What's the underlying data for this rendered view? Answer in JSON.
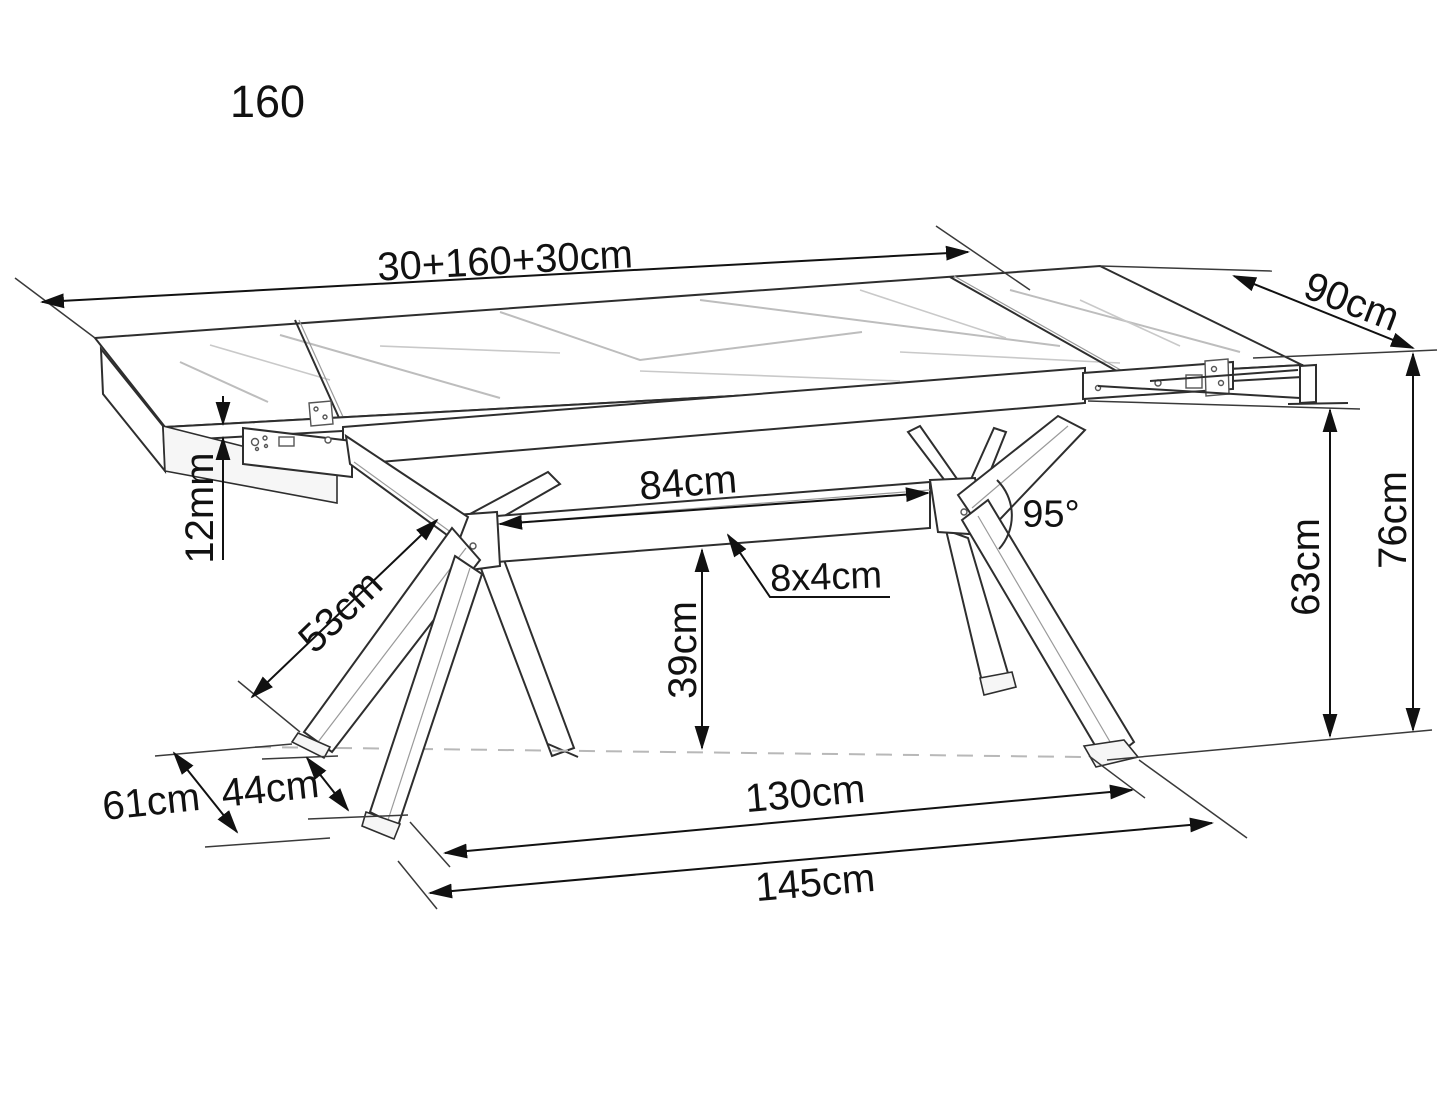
{
  "diagram": {
    "type": "furniture-dimension-drawing",
    "subject": "extendable dining table with spider metal legs and two extension leaves",
    "model_code": "160",
    "colors": {
      "background": "#ffffff",
      "linework": "#2e2e2e",
      "dimension_lines": "#111111",
      "marble_veins": "#c9c9c9",
      "floor_dashed_line": "#b8b8b8",
      "text": "#111111"
    },
    "dims": {
      "total_length": {
        "label": "30+160+30cm",
        "meaning": "tabletop length: leaf + main top + leaf"
      },
      "depth": {
        "label": "90cm",
        "meaning": "tabletop depth"
      },
      "top_thickness": {
        "label": "12mm",
        "meaning": "tabletop thickness"
      },
      "leg_strut": {
        "label": "53cm",
        "meaning": "leg strut length"
      },
      "beam_span": {
        "label": "84cm",
        "meaning": "clear span of center beam between legs"
      },
      "leg_angle": {
        "label": "95°",
        "meaning": "angle between leg struts"
      },
      "beam_section": {
        "label": "8x4cm",
        "meaning": "beam cross-section"
      },
      "beam_clearance": {
        "label": "39cm",
        "meaning": "beam height above floor"
      },
      "underframe_height": {
        "label": "63cm",
        "meaning": "clearance under apron"
      },
      "table_height": {
        "label": "76cm",
        "meaning": "overall table height"
      },
      "foot_depth_outer": {
        "label": "61cm",
        "meaning": "outer foot spread, depth"
      },
      "foot_depth_inner": {
        "label": "44cm",
        "meaning": "inner foot spread, depth"
      },
      "feet_span": {
        "label": "130cm",
        "meaning": "foot spread along length"
      },
      "feet_span_outer": {
        "label": "145cm",
        "meaning": "outer foot spread along length"
      }
    }
  }
}
